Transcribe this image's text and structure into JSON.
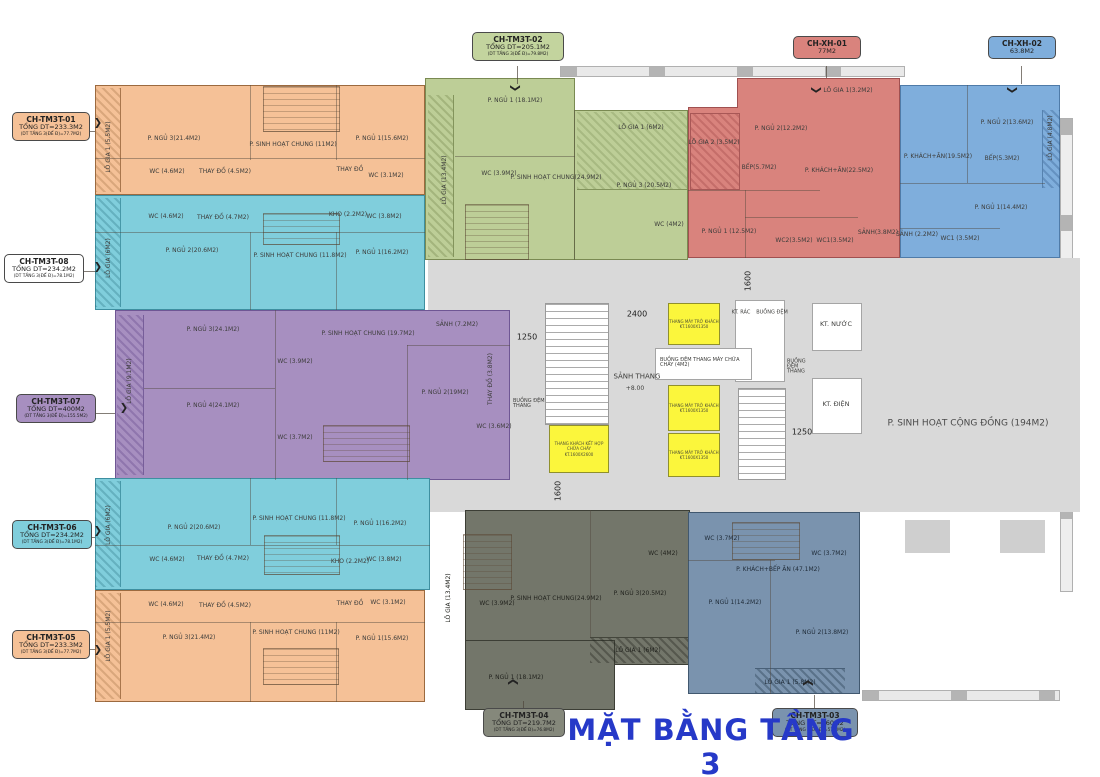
{
  "title": "MẶT BẰNG TẦNG 3",
  "colors": {
    "orange": "#F5C197",
    "cyan": "#80CEDC",
    "purple": "#A78FC0",
    "green": "#BDCE97",
    "red": "#D9837D",
    "blue": "#7FAEDC",
    "dark_gray": "#73766A",
    "slate": "#7A93AE",
    "core_gray": "#D9D9D9",
    "lift_yellow": "#FBF63C",
    "title_blue": "#2639C8"
  },
  "legend": {
    "tm3t01": {
      "id": "CH-TM3T-01",
      "total": "TỔNG DT=233.3M2",
      "floor": "(DT TẦNG 3(ĐẾ Đ)=77.7M2)"
    },
    "tm3t08": {
      "id": "CH-TM3T-08",
      "total": "TỔNG DT=234.2M2",
      "floor": "(DT TẦNG 3(ĐẾ Đ)=78.1M2)"
    },
    "tm3t07": {
      "id": "CH-TM3T-07",
      "total": "TỔNG DT=400M2",
      "floor": "(DT TẦNG 3(ĐẾ Đ)=155.5M2)"
    },
    "tm3t06": {
      "id": "CH-TM3T-06",
      "total": "TỔNG DT=234.2M2",
      "floor": "(DT TẦNG 3(ĐẾ Đ)=78.1M2)"
    },
    "tm3t05": {
      "id": "CH-TM3T-05",
      "total": "TỔNG DT=233.3M2",
      "floor": "(DT TẦNG 3(ĐẾ Đ)=77.7M2)"
    },
    "tm3t02": {
      "id": "CH-TM3T-02",
      "total": "TỔNG DT=205.1M2",
      "floor": "(DT TẦNG 3(ĐẾ Đ)=79.8M2)"
    },
    "xh01": {
      "id": "CH-XH-01",
      "total": "77M2"
    },
    "xh02": {
      "id": "CH-XH-02",
      "total": "63.8M2"
    },
    "tm3t04": {
      "id": "CH-TM3T-04",
      "total": "TỔNG DT=219.7M2",
      "floor": "(DT TẦNG 3(ĐẾ Đ)=76.8M2)"
    },
    "tm3t03": {
      "id": "CH-TM3T-03",
      "total": "TỔNG DT=160M2",
      "floor": "(DT TẦNG 3(ĐẾ Đ)=57.8M2)"
    }
  },
  "units": {
    "tm3t01": {
      "rooms": [
        "LÔ GIA 1 (5.5M2)",
        "P. NGỦ 3(21.4M2)",
        "P. SINH HOẠT CHUNG (11M2)",
        "P. NGỦ 1(15.6M2)",
        "WC (4.6M2)",
        "THAY ĐỒ (4.5M2)",
        "THAY ĐỒ",
        "WC (3.1M2)"
      ]
    },
    "tm3t08": {
      "rooms": [
        "LÔ GIA (6M2)",
        "WC (4.6M2)",
        "THAY ĐỒ (4.7M2)",
        "KHO (2.2M2)",
        "WC (3.8M2)",
        "P. NGỦ 2(20.6M2)",
        "P. SINH HOẠT CHUNG (11.8M2)",
        "P. NGỦ 1(16.2M2)"
      ]
    },
    "tm3t07": {
      "rooms": [
        "LÔ GIA (9.1M2)",
        "P. NGỦ 3(24.1M2)",
        "P. SINH HOẠT CHUNG (19.7M2)",
        "SẢNH (7.2M2)",
        "WC (3.9M2)",
        "P. NGỦ 4(24.1M2)",
        "WC (3.7M2)",
        "P. NGỦ 2(19M2)",
        "THAY ĐỒ (3.8M2)",
        "WC (3.6M2)"
      ]
    },
    "tm3t06": {
      "rooms": [
        "LÔ GIA (6M2)",
        "P. NGỦ 2(20.6M2)",
        "P. SINH HOẠT CHUNG (11.8M2)",
        "P. NGỦ 1(16.2M2)",
        "WC (4.6M2)",
        "THAY ĐỒ (4.7M2)",
        "KHO (2.2M2)",
        "WC (3.8M2)"
      ]
    },
    "tm3t05": {
      "rooms": [
        "LÔ GIA 1 (5.5M2)",
        "WC (4.6M2)",
        "THAY ĐỒ (4.5M2)",
        "THAY ĐỒ",
        "WC (3.1M2)",
        "P. NGỦ 3(21.4M2)",
        "P. SINH HOẠT CHUNG (11M2)",
        "P. NGỦ 1(15.6M2)"
      ]
    },
    "tm3t02": {
      "rooms": [
        "LÔ GIA (13.4M2)",
        "P. NGỦ 1 (18.1M2)",
        "LÔ GIA 1 (6M2)",
        "WC (3.9M2)",
        "P. SINH HOẠT CHUNG(24.9M2)",
        "P. NGỦ 3 (20.5M2)",
        "WC (4M2)"
      ]
    },
    "xh01": {
      "rooms": [
        "LÔ GIA 1(3.2M2)",
        "LÔ GIA 2 (3.5M2)",
        "P. NGỦ 2(12.2M2)",
        "BẾP(5.7M2)",
        "P. KHÁCH+ĂN(22.5M2)",
        "P. NGỦ 1 (12.5M2)",
        "WC2(3.5M2)",
        "WC1(3.5M2)",
        "SẢNH(3.8M2)"
      ]
    },
    "xh02": {
      "rooms": [
        "P. NGỦ 2(13.6M2)",
        "LÔ GIA (4.8M2)",
        "P. KHÁCH+ĂN(19.5M2)",
        "BẾP(5.3M2)",
        "P. NGỦ 1(14.4M2)",
        "SẢNH (2.2M2)",
        "WC1 (3.5M2)"
      ]
    },
    "tm3t04": {
      "rooms": [
        "LÔ GIA (13.4M2)",
        "WC (3.9M2)",
        "P. SINH HOẠT CHUNG(24.9M2)",
        "P. NGỦ 3(20.5M2)",
        "WC (4M2)",
        "LÔ GIA 1 (6M2)",
        "P. NGỦ 1 (18.1M2)"
      ]
    },
    "tm3t03": {
      "rooms": [
        "WC (3.7M2)",
        "WC (3.7M2)",
        "P. KHÁCH+BẾP ĂN (47.1M2)",
        "P. NGỦ 1(14.2M2)",
        "P. NGỦ 2(13.8M2)",
        "LÔ GIA 1 (5.8M2)"
      ]
    }
  },
  "core": {
    "lobby": "SẢNH THANG",
    "level": "+8.00",
    "buffer_left": "BUỒNG ĐỆM THANG",
    "fire_lift_lobby": "BUỒNG ĐỆM THANG MÁY CHỮA CHÁY (4M2)",
    "trash": "KT. RÁC",
    "buffer": "BUỒNG ĐỆM",
    "buffer_right": "BUỒNG ĐỆM THANG",
    "water": "KT. NƯỚC",
    "electric": "KT. ĐIỆN",
    "community": "P. SINH HOẠT CỘNG ĐỒNG (194M2)",
    "lift_small_1": "THANG MÁY TRỞ KHÁCH",
    "lift_small_2": "KT.1600X1350",
    "lift_big_1": "THANG KHÁCH KẾT HỢP CHỮA CHÁY",
    "lift_big_2": "KT.1600X2600",
    "dims": {
      "d1250l": "1250",
      "d2400": "2400",
      "d1600t": "1600",
      "d1600b": "1600",
      "d1250r": "1250"
    }
  }
}
